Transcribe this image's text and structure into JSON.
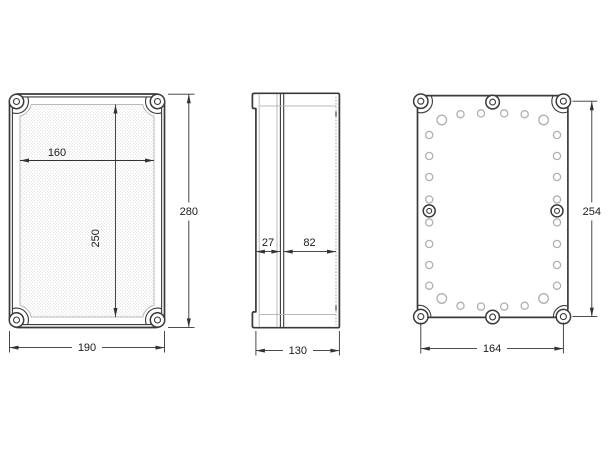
{
  "drawing": {
    "type": "enclosure-dimension-drawing",
    "background": "#ffffff",
    "colors": {
      "outline": "#3a3a3a",
      "thin_line": "#b9b9b9",
      "hole_outline": "#b0b0b0",
      "dimension_line": "#333333",
      "label_text": "#1a1a1a",
      "texture_dot": "#dcdcdc"
    },
    "views": {
      "front": {
        "name": "front view",
        "dims": {
          "inner_width": "160",
          "inner_height": "250",
          "outer_height": "280",
          "outer_width": "190"
        }
      },
      "side": {
        "name": "side view",
        "dims": {
          "lid_depth": "27",
          "base_depth": "82",
          "overall_depth": "130"
        }
      },
      "back": {
        "name": "rear view",
        "dims": {
          "fixing_centres_height": "254",
          "fixing_centres_width": "164"
        }
      }
    }
  }
}
